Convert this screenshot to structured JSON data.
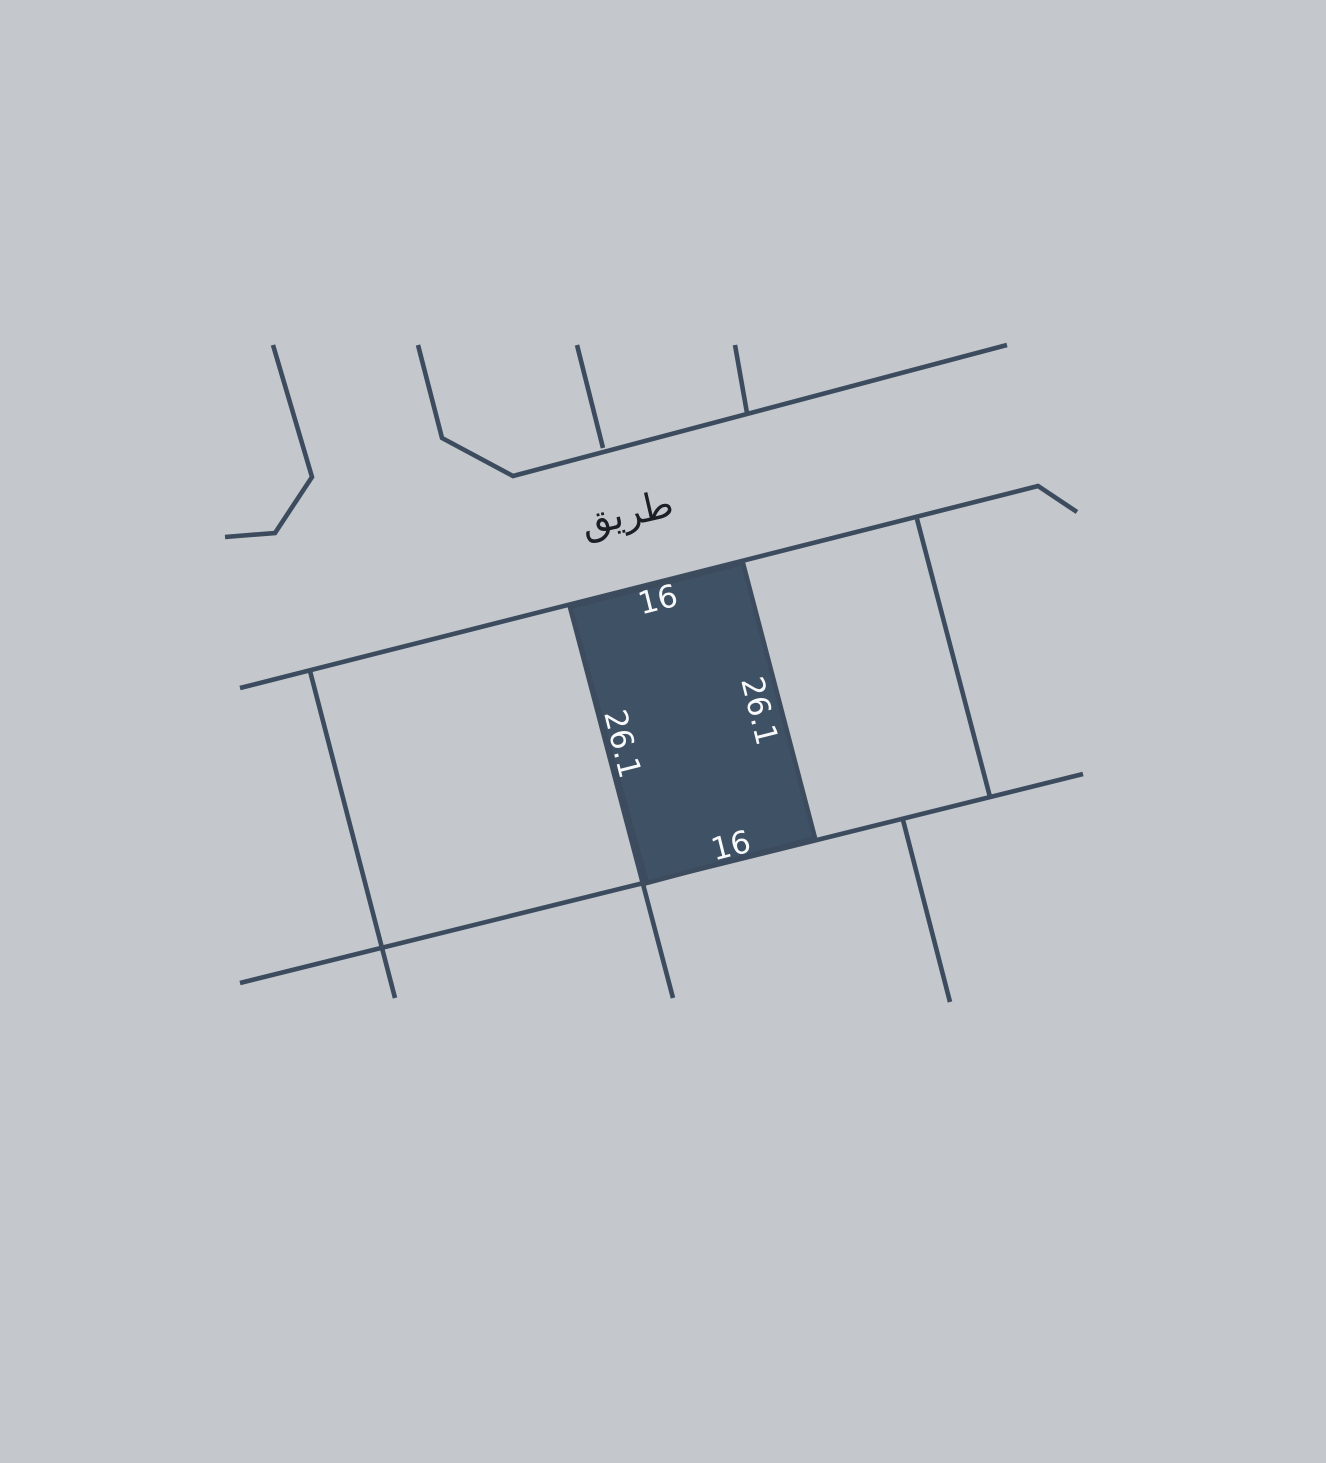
{
  "title": "Cadastral parcel map",
  "colors": {
    "background": "#c4c8cc",
    "boundary_line": "#3c4c5e",
    "parcel_fill": "#3f5164",
    "dimension_label": "#f8f9fa",
    "road_label": "#1b1f26"
  },
  "road": {
    "label": "طريق"
  },
  "parcel": {
    "status": "highlighted",
    "dimensions": {
      "top": "16",
      "right": "26.1",
      "bottom": "16",
      "left": "26.1"
    }
  },
  "geometry": {
    "canvas": {
      "width": 1326,
      "height": 1463
    },
    "stroke_width": 4.6,
    "boundary_polylines": [
      {
        "name": "north-block-boundary-1",
        "points": [
          [
            273,
            345
          ],
          [
            312,
            477
          ],
          [
            275,
            533
          ],
          [
            225,
            537
          ]
        ]
      },
      {
        "name": "north-road-edge",
        "points": [
          [
            418,
            345
          ],
          [
            442,
            438
          ],
          [
            513,
            476
          ],
          [
            1007,
            345
          ]
        ]
      },
      {
        "name": "north-block-divider-1",
        "points": [
          [
            577,
            345
          ],
          [
            603,
            448
          ]
        ]
      },
      {
        "name": "north-block-divider-2",
        "points": [
          [
            735,
            345
          ],
          [
            747,
            413
          ]
        ]
      },
      {
        "name": "south-road-edge",
        "points": [
          [
            240,
            688
          ],
          [
            1038,
            486
          ],
          [
            1077,
            512
          ]
        ]
      },
      {
        "name": "east-parcel-boundary",
        "points": [
          [
            917,
            519
          ],
          [
            990,
            797
          ]
        ]
      },
      {
        "name": "west-parcel-divider",
        "points": [
          [
            310,
            671
          ],
          [
            395,
            998
          ]
        ]
      },
      {
        "name": "south-block-boundary",
        "points": [
          [
            240,
            983
          ],
          [
            1083,
            774
          ]
        ]
      },
      {
        "name": "south-block-divider-1",
        "points": [
          [
            903,
            820
          ],
          [
            950,
            1002
          ]
        ]
      },
      {
        "name": "parcel-west-boundary",
        "points": [
          [
            570,
            607
          ],
          [
            673,
            998
          ]
        ]
      }
    ],
    "parcel_points": [
      [
        570,
        607
      ],
      [
        743,
        563
      ],
      [
        815,
        838
      ],
      [
        647,
        883
      ]
    ],
    "labels": [
      {
        "name": "road-name-label",
        "bind": "road.label",
        "x": 627,
        "y": 513,
        "rotation": -13,
        "font_size": 38,
        "color_key": "road_label"
      },
      {
        "name": "dimension-label-top",
        "bind": "parcel.dimensions.top",
        "x": 658,
        "y": 600,
        "rotation": -14,
        "font_size": 31,
        "color_key": "dimension_label"
      },
      {
        "name": "dimension-label-right",
        "bind": "parcel.dimensions.right",
        "x": 759,
        "y": 711,
        "rotation": 76,
        "font_size": 31,
        "color_key": "dimension_label"
      },
      {
        "name": "dimension-label-bottom",
        "bind": "parcel.dimensions.bottom",
        "x": 731,
        "y": 846,
        "rotation": -14,
        "font_size": 31,
        "color_key": "dimension_label"
      },
      {
        "name": "dimension-label-left",
        "bind": "parcel.dimensions.left",
        "x": 622,
        "y": 744,
        "rotation": 76,
        "font_size": 31,
        "color_key": "dimension_label"
      }
    ]
  }
}
